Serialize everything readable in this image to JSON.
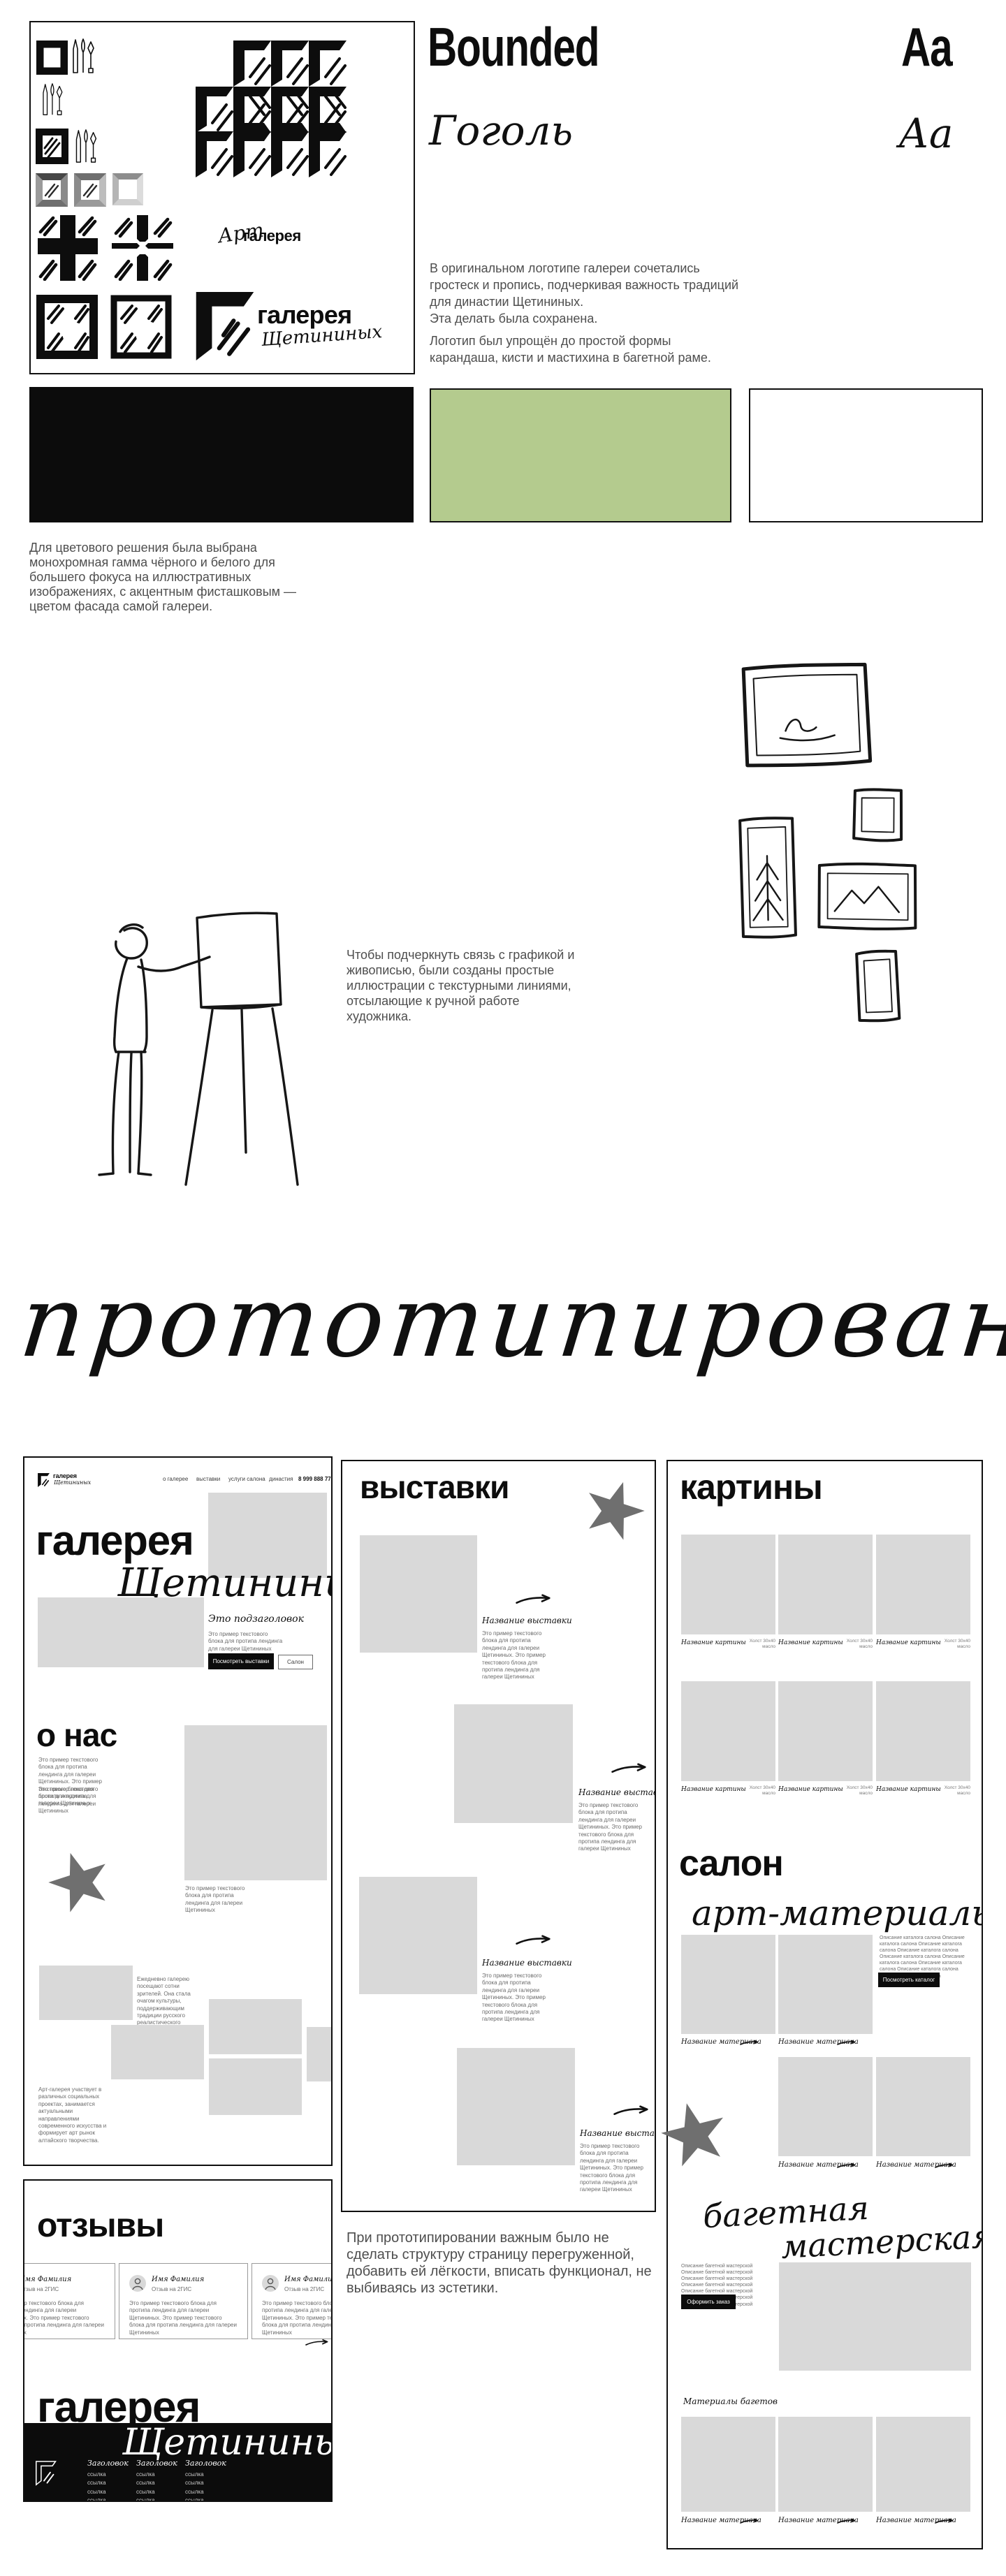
{
  "typography": {
    "primary_name": "Bounded",
    "primary_specimen": "Aa",
    "secondary_name": "Гоголь",
    "secondary_specimen": "Аа",
    "para_logo_1": "В оригинальном логотипе галереи сочетались гростеск и пропись, подчеркивая важность традиций для династии Щетининых.\nЭта делать была сохранена.",
    "para_logo_2": "Логотип был упрощён до простой формы карандаша, кисти и мастихина в багетной раме."
  },
  "palette": {
    "black": "#0c0c0c",
    "pistachio": "#b4cb8e",
    "white": "#ffffff",
    "paragraph": "Для цветового решения была выбрана монохромная гамма чёрного и белого для большего фокуса на иллюстративных изображениях, с акцентным фисташковым  — цветом фасада самой галереи."
  },
  "board": {
    "art_script": "Арт",
    "art_bold": "галерея",
    "logo_bold": "галерея",
    "logo_script": "Щетининых"
  },
  "illustration": {
    "paragraph": "Чтобы подчеркнуть связь с графикой и живописью, были созданы простые иллюстрации с текстурными линиями, отсылающие к ручной работе художника."
  },
  "section_title": "прототипирование",
  "prototype_note": "При прототипировании важным было не сделать структуру страницу перегруженной, добавить ей лёгкости, вписать функционал, не выбиваясь из эстетики.",
  "sample": {
    "short": "Это пример текстового блока для протипа лендинга для галереи Щетининых",
    "long": "Это пример текстового блока для протипа лендинга для галереи Щетининых. Это пример текстового блока для протипа лендинга для галереи Щетининых"
  },
  "landing": {
    "nav": [
      "о галерее",
      "выставки",
      "услуги салона",
      "династия"
    ],
    "phone": "8 999 888 77 66",
    "hero": {
      "title": "галерея",
      "script": "Щетининых",
      "subtitle": "Это подзаголовок",
      "btn_primary": "Посмотреть выставки",
      "btn_secondary": "Салон"
    },
    "about": {
      "title": "о нас"
    },
    "collage": {
      "text1": "Ежедневно галерею посещают сотни зрителей. Она стала очагом культуры, поддерживающим традиции русского реалистического искусства.",
      "text2": "Арт-галерея участвует в различных социальных проектах, занимается актуальными направлениями современного искусства и формирует арт рынок алтайского творчества."
    },
    "reviews": {
      "title": "отзывы",
      "name": "Имя Фамилия",
      "source": "Отзыв на 2ГИС"
    },
    "footer": {
      "title": "галерея",
      "script": "Щетининых",
      "col_title": "Заголовок",
      "link": "ссылка"
    },
    "exhibitions": {
      "title": "выставки",
      "item": "Название выставки"
    },
    "paintings": {
      "title": "картины",
      "item": "Название картины",
      "meta1": "Холст 30х40",
      "meta2": "масло"
    },
    "salon": {
      "title": "салон",
      "script": "арт-материалы",
      "desc": "Описание каталога салона Описание каталога салона Описание каталога салона Описание каталога салона Описание каталога салона Описание каталога салона Описание каталога салона Описание каталога салона Описание каталога салона",
      "btn": "Посмотреть каталог",
      "item": "Название материала"
    },
    "baget": {
      "script1": "багетная",
      "script2": "мастерская",
      "desc": "Описание багетной мастерской Описание багетной мастерской Описание багетной мастерской Описание багетной мастерской Описание багетной мастерской Описание багетной мастерской Описание багетной мастерской",
      "btn": "Оформить заказ",
      "label": "Материалы багетов"
    }
  }
}
